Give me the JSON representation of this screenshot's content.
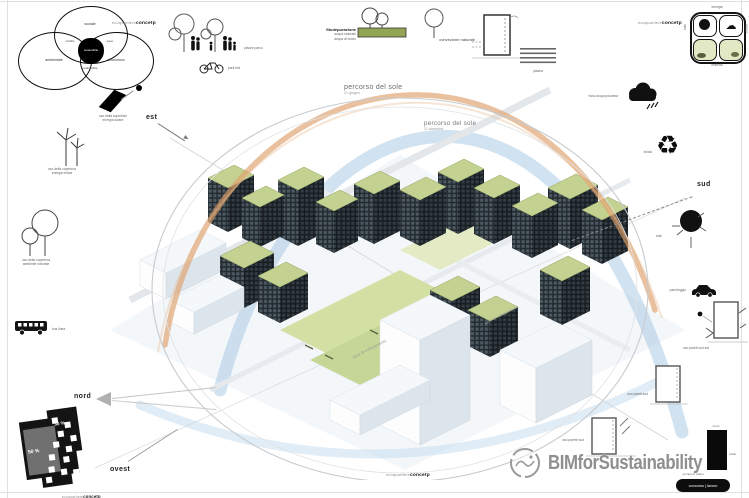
{
  "board": {
    "concept_prefix": "ecoquartiere",
    "concept_bold": "concetp"
  },
  "icons": {
    "recycle": "♻",
    "cloud": "☁"
  },
  "venn": {
    "top": "sociale",
    "left": "ambientale",
    "right": "economico",
    "overlap_left": "vivibile",
    "overlap_right": "equo",
    "overlap_bottom": "realizzabile",
    "center": "sostenibile"
  },
  "compass": {
    "est": "est",
    "sud": "sud",
    "ovest": "ovest",
    "nord": "nord"
  },
  "top_row": {
    "park_label": "piazze parco",
    "bike_label": "park bici",
    "fito_title": "fitodepurazione",
    "fito_sub1": "acqua naturale",
    "fito_sub2": "acqua di riciclo",
    "convection_label": "convezione naturale",
    "slab_label": "piastra"
  },
  "concept_grid": {
    "top": "energia",
    "right": "acqua",
    "bottom": "materia",
    "left": "sole"
  },
  "left_column": {
    "solar_line1": "uso della superficie",
    "solar_line2": "energia solare",
    "wind_line1": "uso della copertura",
    "wind_line2": "energia eolica",
    "tree_line1": "uso della copertura",
    "tree_line2": "ambiente naturale",
    "bus_label": "bus linea"
  },
  "right_column": {
    "rain_label": "riuso acqua piovana",
    "recycle_label": "ricicla",
    "sun_label": "sole",
    "parking_label": "parcheggio",
    "wall_se_label": "uso pareti sud est",
    "wall_s_label": "uso pareti sud",
    "wall_w_label": "uso parete sud",
    "monolith_top": "muro",
    "monolith_side": "caldo",
    "monolith_bottom": "pompa di calore",
    "credit_button": "concorso | lavoro"
  },
  "sun_paths": {
    "summer_title": "percorso del sole",
    "summer_sub": "21 giugno",
    "winter_title": "percorso del sole",
    "winter_sub": "21 dicembre"
  },
  "site_plan": {
    "pct_upper": "30 %",
    "pct_lower": "50 %"
  },
  "scene": {
    "street_label_1": "asse di collegamento",
    "street_label_2": "asse di collegamento"
  },
  "watermark": {
    "text": "BIMforSustainability"
  }
}
